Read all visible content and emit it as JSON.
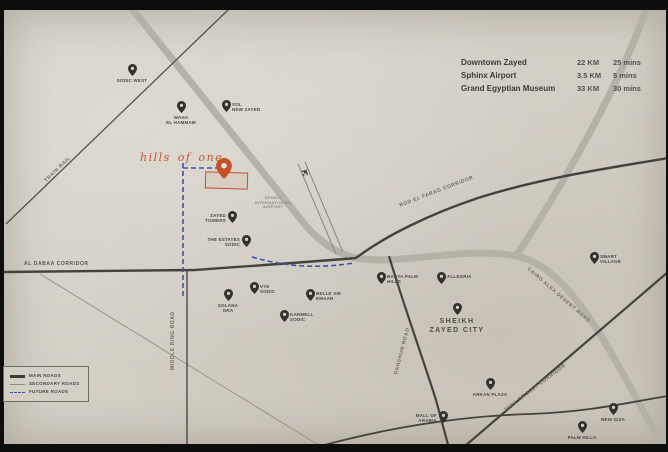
{
  "map": {
    "logo_text": "hills of one",
    "airplane_glyph": "✈",
    "airport_label_lines": [
      "SPHINX",
      "INTERNATIONAL",
      "AIRPORT"
    ]
  },
  "distance_table": {
    "rows": [
      {
        "name": "Downtown Zayed",
        "distance": "22 KM",
        "time": "25 mins"
      },
      {
        "name": "Sphinx Airport",
        "distance": "3.5 KM",
        "time": "5 mins"
      },
      {
        "name": "Grand Egyptian Museum",
        "distance": "33 KM",
        "time": "30 mins"
      }
    ]
  },
  "legend": {
    "items": [
      {
        "label": "MAIN ROADS",
        "type": "main"
      },
      {
        "label": "SECONDARY ROADS",
        "type": "secondary"
      },
      {
        "label": "FUTURE ROADS",
        "type": "future"
      }
    ]
  },
  "road_labels": [
    {
      "id": "train-rail",
      "text": "TRAIN RAIL"
    },
    {
      "id": "al-dabaa-corridor",
      "text": "AL DABAA CORRIDOR"
    },
    {
      "id": "middle-ring-road",
      "text": "MIDDLE RING ROAD"
    },
    {
      "id": "rod-el-farag-corridor",
      "text": "ROD EL FARAG CORRIDOR"
    },
    {
      "id": "cairo-alex-desert-road",
      "text": "CAIRO ALEX DESERT ROAD"
    },
    {
      "id": "dahshur-road",
      "text": "DAHSHUR ROAD"
    },
    {
      "id": "26th-of-july-corridor",
      "text": "26TH OF JULY CORRIDOR"
    }
  ],
  "markers": [
    {
      "id": "sodic-west",
      "x": 132,
      "y": 76,
      "pos": "below",
      "lines": [
        "SODIC WEST"
      ]
    },
    {
      "id": "waha-el-hammam",
      "x": 181,
      "y": 113,
      "pos": "below",
      "lines": [
        "WAHA",
        "EL HAMMAM"
      ]
    },
    {
      "id": "sol-new-zayed",
      "x": 226,
      "y": 112,
      "pos": "right",
      "lines": [
        "SOL",
        "NEW ZAYED"
      ]
    },
    {
      "id": "zayed-towers",
      "x": 232,
      "y": 223,
      "pos": "left",
      "lines": [
        "ZAYED",
        "TOWERS"
      ]
    },
    {
      "id": "the-estates-sodic",
      "x": 246,
      "y": 247,
      "pos": "left",
      "lines": [
        "THE ESTATES",
        "SODIC"
      ]
    },
    {
      "id": "solana-ora",
      "x": 228,
      "y": 301,
      "pos": "below",
      "lines": [
        "SOLANA",
        "ORA"
      ]
    },
    {
      "id": "vye-sodic",
      "x": 254,
      "y": 294,
      "pos": "right",
      "lines": [
        "VYE",
        "SODIC"
      ]
    },
    {
      "id": "belle-vie-emaar",
      "x": 310,
      "y": 301,
      "pos": "right",
      "lines": [
        "BELLE VIE",
        "EMAAR"
      ]
    },
    {
      "id": "karmell-sodic",
      "x": 284,
      "y": 322,
      "pos": "right",
      "lines": [
        "KARMELL",
        "SODIC"
      ]
    },
    {
      "id": "badya-palm-hills",
      "x": 381,
      "y": 284,
      "pos": "right",
      "lines": [
        "BADYA PALM",
        "HILLS"
      ]
    },
    {
      "id": "allegria",
      "x": 441,
      "y": 284,
      "pos": "right",
      "lines": [
        "ALLEGRIA"
      ]
    },
    {
      "id": "sheikh-zayed-city",
      "x": 457,
      "y": 315,
      "pos": "below",
      "big": true,
      "lines": [
        "SHEIKH",
        "ZAYED CITY"
      ]
    },
    {
      "id": "smart-village",
      "x": 594,
      "y": 264,
      "pos": "right",
      "lines": [
        "SMART",
        "VILLAGE"
      ]
    },
    {
      "id": "arkan-plaza",
      "x": 490,
      "y": 390,
      "pos": "below",
      "lines": [
        "ARKAN PLAZA"
      ]
    },
    {
      "id": "mall-of-arabia",
      "x": 443,
      "y": 423,
      "pos": "left",
      "lines": [
        "MALL OF",
        "ARABIA"
      ]
    },
    {
      "id": "new-giza",
      "x": 613,
      "y": 415,
      "pos": "below",
      "lines": [
        "NEW GIZA"
      ]
    },
    {
      "id": "palm-hills",
      "x": 582,
      "y": 433,
      "pos": "below",
      "lines": [
        "PALM HILLS"
      ]
    }
  ],
  "colors": {
    "accent": "#c4502a",
    "paper": "#d4cfc5",
    "road_main": "#b6b1a7",
    "road_dark": "#454239",
    "future_road": "#3f51b5",
    "ink": "#3a3835"
  }
}
